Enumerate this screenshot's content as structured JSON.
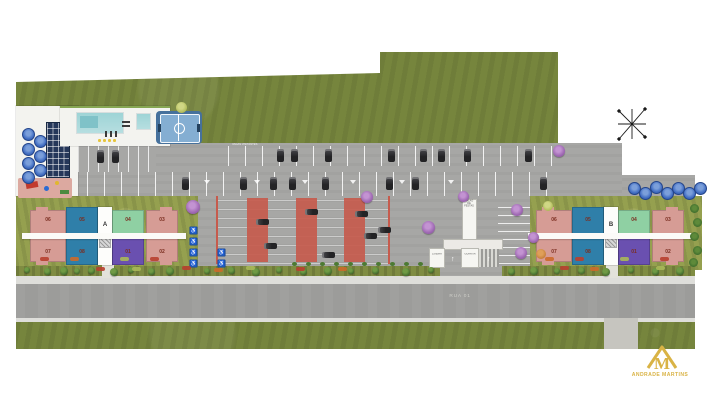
{
  "buildings": [
    {
      "label": "A",
      "units_top": [
        "06",
        "05",
        "04",
        "03"
      ],
      "units_bottom": [
        "07",
        "08",
        "01",
        "02"
      ],
      "top_colors": [
        "pink",
        "blue",
        "green",
        "pink"
      ],
      "bottom_colors": [
        "pink",
        "blue",
        "purple",
        "pink"
      ]
    },
    {
      "label": "B",
      "units_top": [
        "06",
        "05",
        "04",
        "03"
      ],
      "units_bottom": [
        "07",
        "08",
        "01",
        "02"
      ],
      "top_colors": [
        "pink",
        "blue",
        "green",
        "pink"
      ],
      "bottom_colors": [
        "pink",
        "blue",
        "purple",
        "pink"
      ]
    }
  ],
  "labels": {
    "road": "RUA 01",
    "gatehouse": "GUARITA",
    "hall_line1": "SALÃO",
    "hall_line2": "DE FESTAS",
    "trash": "LIXEIRA",
    "parking_note": "VAGAS VISITANTES"
  },
  "logo": {
    "name": "ANDRADE MARTINS"
  },
  "icons": {
    "compass": "compass-rose",
    "accessible": "♿",
    "visitor_marker": "triangle-down",
    "arrow_up": "↑"
  },
  "colors": {
    "grass": "#76853d",
    "lot": "#a7a7a5",
    "road": "#9c9c9a",
    "deck": "#f3f3ef",
    "pool": "#9fd6d6",
    "court": "#46719c",
    "courtInner": "#84aed2",
    "solar": "#25375a",
    "red": "#c65b4d",
    "pink": "#d69c95",
    "blue": "#2f7fa9",
    "green": "#8fd0a3",
    "purple": "#6a50b0",
    "unitNum": "#7b2d20",
    "yard": "#95a04f",
    "landscape": "#7f8c42",
    "sidewalk": "#dededa",
    "gold": "#d9b345"
  }
}
